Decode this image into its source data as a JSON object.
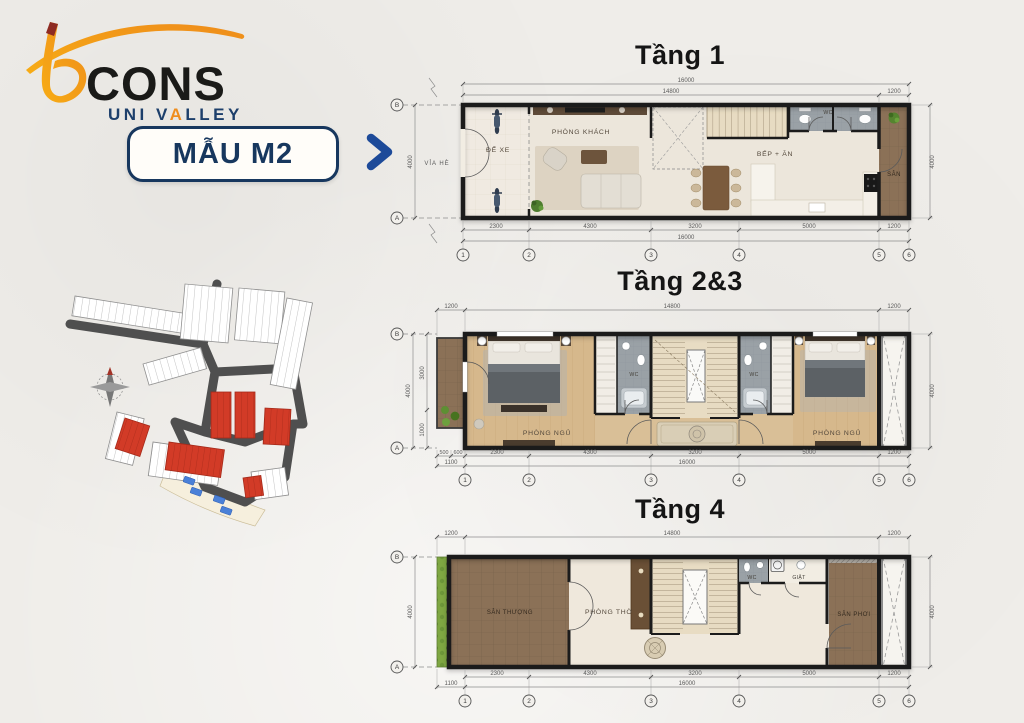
{
  "poster": {
    "bg": "#efede9"
  },
  "brand": {
    "logo_word": "CONS",
    "logo_sub_pre": "UNI V",
    "logo_sub_a": "A",
    "logo_sub_post": "LLEY",
    "model_label": "MẪU M2",
    "navy": "#17375e",
    "arrow_blue": "#1d4a99",
    "gold": "#f5a81c"
  },
  "site_map": {
    "red_lot_color": "#d23b27",
    "road_color": "#4f4f4f"
  },
  "plans": [
    {
      "title": "Tầng 1",
      "labels": {
        "via_he": "VỈA HÈ",
        "de_xe": "ĐỂ XE",
        "phong_khach": "PHÒNG KHÁCH",
        "bep_an": "BẾP + ĂN",
        "wc": "WC",
        "san": "SÂN"
      },
      "dims": {
        "total": "16000",
        "top": [
          "14800",
          "1200"
        ],
        "bottom": [
          "2300",
          "4300",
          "3200",
          "5000",
          "1200"
        ],
        "left": "4000",
        "right": "4000"
      },
      "grid": {
        "cols": [
          "1",
          "2",
          "3",
          "4",
          "5",
          "6"
        ],
        "row_top": "B",
        "row_bottom": "A"
      }
    },
    {
      "title": "Tầng 2&3",
      "labels": {
        "phong_ngu_l": "PHÒNG NGỦ",
        "wc_l": "WC",
        "wc_r": "WC",
        "phong_ngu_r": "PHÒNG NGỦ"
      },
      "dims": {
        "top": [
          "1200",
          "14800",
          "1200"
        ],
        "bottom": [
          "500",
          "600",
          "2300",
          "4300",
          "3200",
          "5000",
          "1200"
        ],
        "bottom2": [
          "1100",
          "16000"
        ],
        "left": [
          "3000",
          "1000",
          "4000"
        ],
        "right": "4000"
      },
      "grid": {
        "cols": [
          "1",
          "2",
          "3",
          "4",
          "5",
          "6"
        ],
        "row_top": "B",
        "row_bottom": "A"
      }
    },
    {
      "title": "Tầng 4",
      "labels": {
        "san_thuong": "SÂN THƯỢNG",
        "phong_tho": "PHÒNG THỜ",
        "wc": "WC",
        "giat": "GIẶT",
        "san_phoi": "SÂN PHƠI"
      },
      "dims": {
        "top": [
          "1200",
          "14800",
          "1200"
        ],
        "bottom": [
          "2300",
          "4300",
          "3200",
          "5000",
          "1200"
        ],
        "bottom2": [
          "1100",
          "16000"
        ],
        "left": "4000",
        "right": "4000"
      },
      "grid": {
        "cols": [
          "1",
          "2",
          "3",
          "4",
          "5",
          "6"
        ],
        "row_top": "B",
        "row_bottom": "A"
      }
    }
  ]
}
